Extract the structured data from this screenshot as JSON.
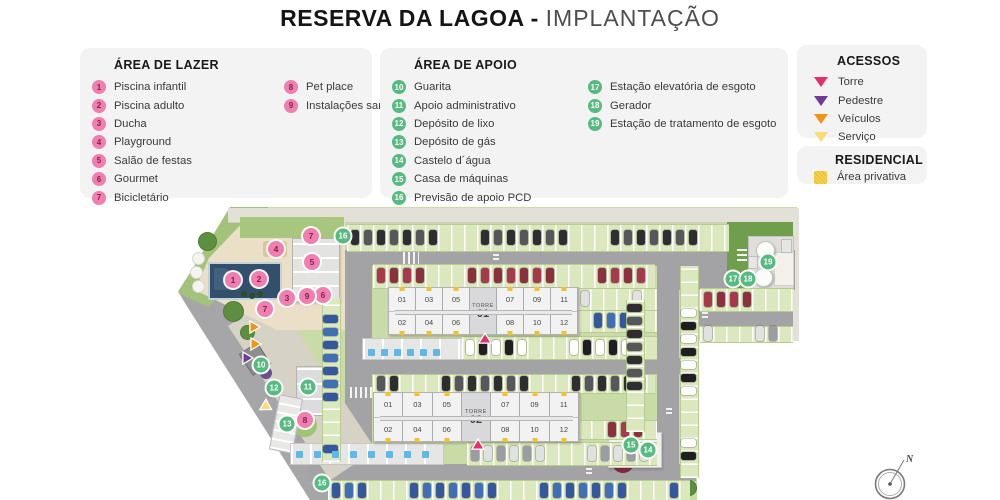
{
  "title": {
    "main": "RESERVA DA LAGOA - ",
    "sub": "IMPLANTAÇÃO"
  },
  "legend_lazer": {
    "title": "ÁREA DE LAZER",
    "columns": [
      [
        {
          "n": "1",
          "label": "Piscina infantil"
        },
        {
          "n": "2",
          "label": "Piscina adulto"
        },
        {
          "n": "3",
          "label": "Ducha"
        },
        {
          "n": "4",
          "label": "Playground"
        },
        {
          "n": "5",
          "label": "Salão de festas"
        },
        {
          "n": "6",
          "label": "Gourmet"
        },
        {
          "n": "7",
          "label": "Bicicletário"
        }
      ],
      [
        {
          "n": "8",
          "label": "Pet place"
        },
        {
          "n": "9",
          "label": "Instalações sanitárias lazer"
        }
      ]
    ]
  },
  "legend_apoio": {
    "title": "ÁREA DE APOIO",
    "columns": [
      [
        {
          "n": "10",
          "label": "Guarita"
        },
        {
          "n": "11",
          "label": "Apoio administrativo"
        },
        {
          "n": "12",
          "label": "Depósito de lixo"
        },
        {
          "n": "13",
          "label": "Depósito de gás"
        },
        {
          "n": "14",
          "label": "Castelo d´água"
        },
        {
          "n": "15",
          "label": "Casa de máquinas"
        },
        {
          "n": "16",
          "label": "Previsão de apoio PCD"
        }
      ],
      [
        {
          "n": "17",
          "label": "Estação elevatória de esgoto"
        },
        {
          "n": "18",
          "label": "Gerador"
        },
        {
          "n": "19",
          "label": "Estação de tratamento de esgoto"
        }
      ]
    ]
  },
  "legend_acessos": {
    "title": "ACESSOS",
    "items": [
      {
        "key": "torre",
        "label": "Torre",
        "color": "#e62e6b"
      },
      {
        "key": "pedestre",
        "label": "Pedestre",
        "color": "#6f3b97"
      },
      {
        "key": "veiculos",
        "label": "Veículos",
        "color": "#ef9413"
      },
      {
        "key": "servico",
        "label": "Serviço",
        "color": "#f9dc7a"
      }
    ]
  },
  "legend_residencial": {
    "title": "RESIDENCIAL",
    "items": [
      {
        "label": "Área privativa",
        "color": "#f6cf4b"
      }
    ]
  },
  "colors": {
    "pink_marker": "#ef7fae",
    "pink_marker_text": "#8d1d52",
    "green_marker": "#57ba81",
    "door_yellow": "#f2c12e",
    "pcd_blue": "#5fb8e8",
    "car_palette": [
      "#2e2e30",
      "#9a9da1",
      "#ffffff",
      "#a63a4a",
      "#33589f",
      "#55575b",
      "#dfe1e3",
      "#1f1f22",
      "#8c2f3e",
      "#3f6fb5"
    ]
  },
  "map": {
    "towers": [
      {
        "name": "TORRE",
        "number": "01",
        "x": 388,
        "y": 287,
        "w": 189,
        "h": 46,
        "units_top": [
          "01",
          "03",
          "05",
          "07",
          "09",
          "11"
        ],
        "units_bottom": [
          "02",
          "04",
          "06",
          "08",
          "10",
          "12"
        ]
      },
      {
        "name": "TORRE",
        "number": "02",
        "x": 373,
        "y": 392,
        "w": 205,
        "h": 48,
        "units_top": [
          "01",
          "03",
          "05",
          "07",
          "09",
          "11"
        ],
        "units_bottom": [
          "02",
          "04",
          "06",
          "08",
          "10",
          "12"
        ]
      }
    ],
    "markers": [
      {
        "n": "1",
        "type": "pink",
        "x": 233,
        "y": 280
      },
      {
        "n": "2",
        "type": "pink",
        "x": 259,
        "y": 279
      },
      {
        "n": "3",
        "type": "pink",
        "x": 287,
        "y": 298
      },
      {
        "n": "4",
        "type": "pink",
        "x": 276,
        "y": 249
      },
      {
        "n": "5",
        "type": "pink",
        "x": 312,
        "y": 262
      },
      {
        "n": "6",
        "type": "pink",
        "x": 323,
        "y": 295
      },
      {
        "n": "7",
        "type": "pink",
        "x": 311,
        "y": 236
      },
      {
        "n": "7",
        "type": "pink",
        "x": 265,
        "y": 309
      },
      {
        "n": "8",
        "type": "pink",
        "x": 305,
        "y": 420
      },
      {
        "n": "9",
        "type": "pink",
        "x": 307,
        "y": 296
      },
      {
        "n": "10",
        "type": "green",
        "x": 261,
        "y": 365
      },
      {
        "n": "11",
        "type": "green",
        "x": 308,
        "y": 387
      },
      {
        "n": "12",
        "type": "green",
        "x": 274,
        "y": 388
      },
      {
        "n": "13",
        "type": "green",
        "x": 287,
        "y": 424
      },
      {
        "n": "14",
        "type": "green",
        "x": 648,
        "y": 450
      },
      {
        "n": "15",
        "type": "green",
        "x": 631,
        "y": 445
      },
      {
        "n": "16",
        "type": "green",
        "x": 343,
        "y": 236
      },
      {
        "n": "16",
        "type": "green",
        "x": 322,
        "y": 483
      },
      {
        "n": "17",
        "type": "green",
        "x": 733,
        "y": 279
      },
      {
        "n": "18",
        "type": "green",
        "x": 748,
        "y": 279
      },
      {
        "n": "19",
        "type": "green",
        "x": 768,
        "y": 262
      }
    ],
    "arrows": [
      {
        "access": "torre",
        "x": 485,
        "y": 336,
        "rot": 180
      },
      {
        "access": "torre",
        "x": 478,
        "y": 442,
        "rot": 180
      },
      {
        "access": "veiculos",
        "x": 257,
        "y": 327,
        "rot": -90
      },
      {
        "access": "veiculos",
        "x": 258,
        "y": 344,
        "rot": -90
      },
      {
        "access": "pedestre",
        "x": 250,
        "y": 358,
        "rot": -90
      },
      {
        "access": "servico",
        "x": 269,
        "y": 408,
        "rot": -60
      }
    ],
    "parking_rows": [
      {
        "x": 347,
        "y": 224,
        "w": 382,
        "h": 26,
        "dir": "h"
      },
      {
        "x": 373,
        "y": 264,
        "w": 282,
        "h": 23,
        "dir": "h"
      },
      {
        "x": 577,
        "y": 288,
        "w": 80,
        "h": 21,
        "dir": "h"
      },
      {
        "x": 577,
        "y": 310,
        "w": 80,
        "h": 21,
        "dir": "h"
      },
      {
        "x": 462,
        "y": 336,
        "w": 195,
        "h": 22,
        "dir": "h"
      },
      {
        "x": 373,
        "y": 374,
        "w": 282,
        "h": 18,
        "dir": "h"
      },
      {
        "x": 578,
        "y": 420,
        "w": 79,
        "h": 18,
        "dir": "h"
      },
      {
        "x": 467,
        "y": 442,
        "w": 190,
        "h": 22,
        "dir": "h"
      },
      {
        "x": 328,
        "y": 480,
        "w": 362,
        "h": 20,
        "dir": "h"
      },
      {
        "x": 680,
        "y": 266,
        "w": 17,
        "h": 212,
        "dir": "v"
      },
      {
        "x": 626,
        "y": 300,
        "w": 17,
        "h": 132,
        "dir": "v"
      },
      {
        "x": 700,
        "y": 288,
        "w": 93,
        "h": 22,
        "dir": "h"
      },
      {
        "x": 700,
        "y": 326,
        "w": 93,
        "h": 15,
        "dir": "h"
      },
      {
        "x": 322,
        "y": 298,
        "w": 17,
        "h": 164,
        "dir": "v"
      }
    ],
    "pcd_rows": [
      {
        "x": 368,
        "y": 349,
        "count": 6,
        "step": 13
      },
      {
        "x": 296,
        "y": 451,
        "count": 8,
        "step": 18
      }
    ],
    "compass": {
      "label": "N"
    }
  }
}
